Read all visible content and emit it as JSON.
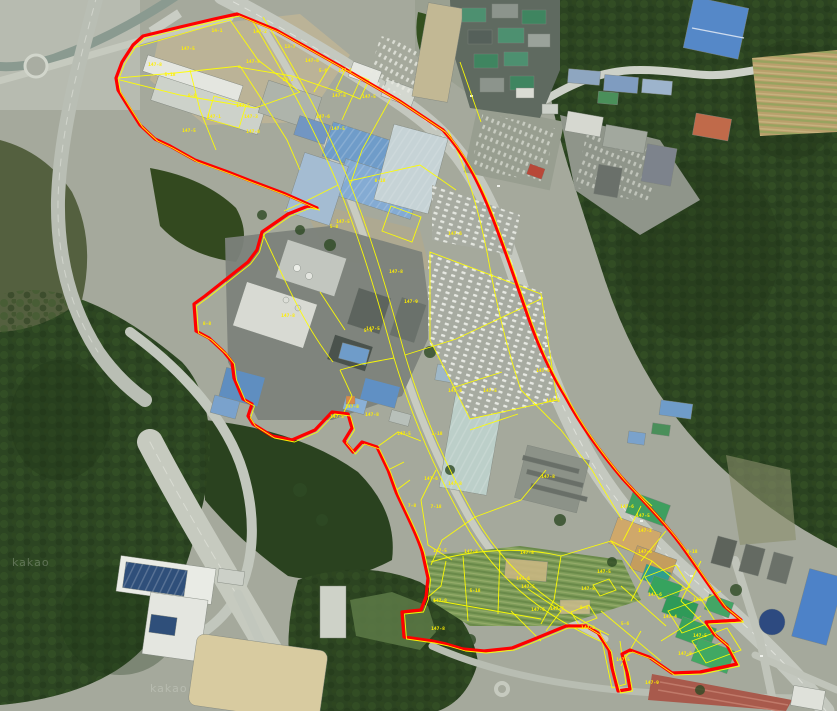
{
  "map": {
    "overlay": {
      "boundary_color": "#ff0000",
      "parcel_line_color": "#ffff00",
      "parcel_label_color": "#ffef00"
    },
    "watermark": "kakao",
    "parcel_labels": [
      {
        "text": "147-5",
        "x": 188,
        "y": 50
      },
      {
        "text": "147-8",
        "x": 155,
        "y": 66
      },
      {
        "text": "14-1",
        "x": 217,
        "y": 32
      },
      {
        "text": "147-2",
        "x": 260,
        "y": 33
      },
      {
        "text": "147-5",
        "x": 253,
        "y": 63
      },
      {
        "text": "13-7",
        "x": 290,
        "y": 48
      },
      {
        "text": "147-6",
        "x": 312,
        "y": 62
      },
      {
        "text": "5-6",
        "x": 323,
        "y": 72
      },
      {
        "text": "147-5",
        "x": 345,
        "y": 72
      },
      {
        "text": "147-8",
        "x": 339,
        "y": 97
      },
      {
        "text": "147-5",
        "x": 369,
        "y": 98
      },
      {
        "text": "13-2",
        "x": 288,
        "y": 81
      },
      {
        "text": "5-18",
        "x": 170,
        "y": 76
      },
      {
        "text": "147-5",
        "x": 243,
        "y": 107
      },
      {
        "text": "147-1",
        "x": 214,
        "y": 118
      },
      {
        "text": "147-3",
        "x": 251,
        "y": 118
      },
      {
        "text": "147-5",
        "x": 189,
        "y": 132
      },
      {
        "text": "147-8",
        "x": 253,
        "y": 133
      },
      {
        "text": "147-6",
        "x": 323,
        "y": 118
      },
      {
        "text": "147-5",
        "x": 338,
        "y": 130
      },
      {
        "text": "8-8",
        "x": 192,
        "y": 97
      },
      {
        "text": "8-18",
        "x": 380,
        "y": 182
      },
      {
        "text": "147-6",
        "x": 455,
        "y": 235
      },
      {
        "text": "147-5",
        "x": 343,
        "y": 223
      },
      {
        "text": "5-8",
        "x": 334,
        "y": 228
      },
      {
        "text": "147-8",
        "x": 396,
        "y": 273
      },
      {
        "text": "147-9",
        "x": 411,
        "y": 303
      },
      {
        "text": "147-8",
        "x": 288,
        "y": 317
      },
      {
        "text": "8-8",
        "x": 207,
        "y": 325
      },
      {
        "text": "147-5",
        "x": 373,
        "y": 330
      },
      {
        "text": "5-4",
        "x": 368,
        "y": 332
      },
      {
        "text": "147-8",
        "x": 352,
        "y": 408
      },
      {
        "text": "147-5",
        "x": 404,
        "y": 435
      },
      {
        "text": "1-18",
        "x": 437,
        "y": 435
      },
      {
        "text": "147-8",
        "x": 455,
        "y": 392
      },
      {
        "text": "147-5",
        "x": 490,
        "y": 392
      },
      {
        "text": "147-6",
        "x": 543,
        "y": 372
      },
      {
        "text": "147-8",
        "x": 455,
        "y": 485
      },
      {
        "text": "147-5",
        "x": 553,
        "y": 402
      },
      {
        "text": "147-8",
        "x": 548,
        "y": 478
      },
      {
        "text": "147-6",
        "x": 431,
        "y": 480
      },
      {
        "text": "7-18",
        "x": 436,
        "y": 508
      },
      {
        "text": "7-8",
        "x": 412,
        "y": 507
      },
      {
        "text": "147-8",
        "x": 471,
        "y": 553
      },
      {
        "text": "147-5",
        "x": 440,
        "y": 552
      },
      {
        "text": "147-8",
        "x": 527,
        "y": 554
      },
      {
        "text": "147-6",
        "x": 627,
        "y": 508
      },
      {
        "text": "147-5",
        "x": 643,
        "y": 517
      },
      {
        "text": "147-2",
        "x": 645,
        "y": 532
      },
      {
        "text": "8-18",
        "x": 692,
        "y": 553
      },
      {
        "text": "147-5",
        "x": 604,
        "y": 573
      },
      {
        "text": "147-8",
        "x": 588,
        "y": 590
      },
      {
        "text": "147-5",
        "x": 528,
        "y": 588
      },
      {
        "text": "147-8",
        "x": 440,
        "y": 602
      },
      {
        "text": "147-6",
        "x": 645,
        "y": 553
      },
      {
        "text": "147-6",
        "x": 655,
        "y": 596
      },
      {
        "text": "147-8",
        "x": 700,
        "y": 601
      },
      {
        "text": "147-4",
        "x": 670,
        "y": 618
      },
      {
        "text": "147-8",
        "x": 588,
        "y": 629
      },
      {
        "text": "5-6",
        "x": 625,
        "y": 625
      },
      {
        "text": "147-5",
        "x": 623,
        "y": 661
      },
      {
        "text": "147-8",
        "x": 685,
        "y": 655
      },
      {
        "text": "147-5",
        "x": 700,
        "y": 637
      },
      {
        "text": "8-8",
        "x": 584,
        "y": 609
      },
      {
        "text": "147-9",
        "x": 652,
        "y": 684
      },
      {
        "text": "147-8",
        "x": 438,
        "y": 630
      },
      {
        "text": "5-18",
        "x": 475,
        "y": 592
      },
      {
        "text": "147-6",
        "x": 523,
        "y": 580
      },
      {
        "text": "147-6",
        "x": 538,
        "y": 611
      },
      {
        "text": "147-7",
        "x": 557,
        "y": 610
      },
      {
        "text": "147-8",
        "x": 372,
        "y": 416
      },
      {
        "text": "147-5",
        "x": 337,
        "y": 418
      }
    ]
  }
}
